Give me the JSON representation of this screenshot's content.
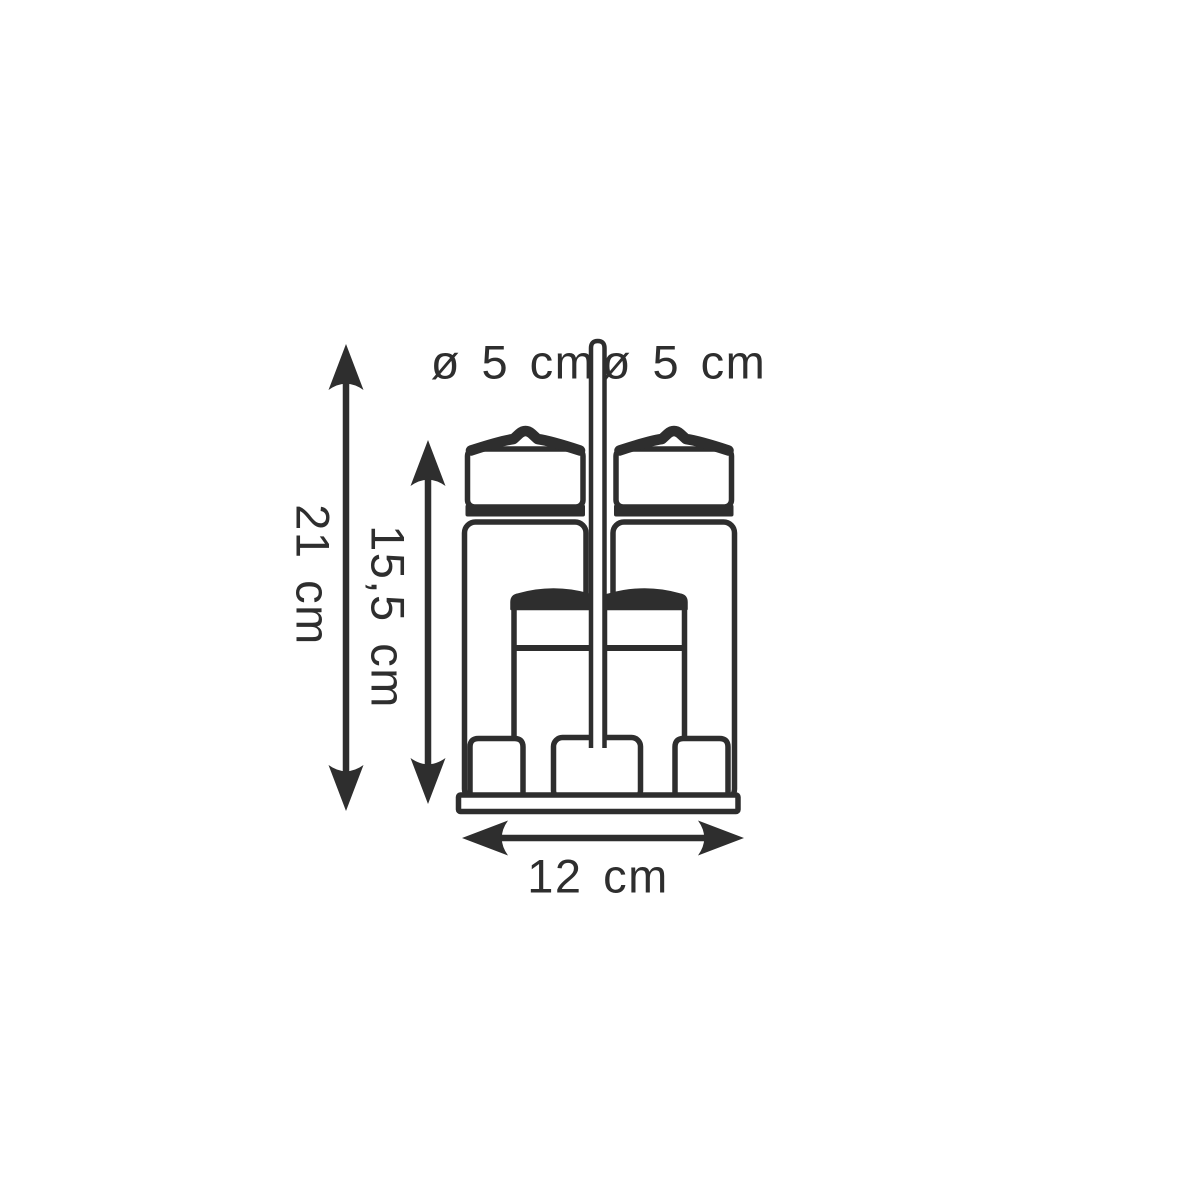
{
  "colors": {
    "background": "#ffffff",
    "ink": "#2e2e2e"
  },
  "dimension_labels": {
    "diameter_left": "ø 5 cm",
    "diameter_right": "ø 5 cm",
    "total_height": "21 cm",
    "bottle_height": "15,5 cm",
    "base_width": "12 cm"
  }
}
